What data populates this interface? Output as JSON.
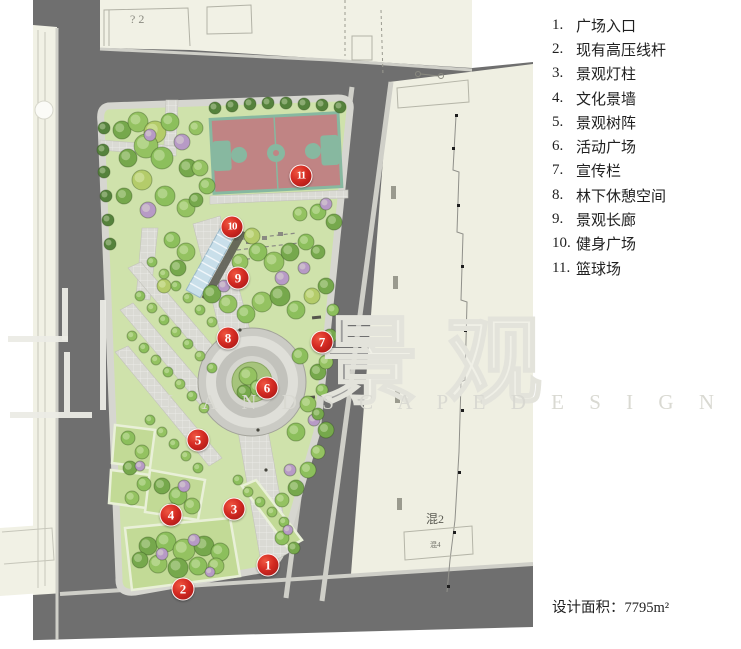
{
  "page": {
    "type": "landscape-site-plan"
  },
  "legend": {
    "items": [
      {
        "num": "1.",
        "label": "广场入口"
      },
      {
        "num": "2.",
        "label": "现有高压线杆"
      },
      {
        "num": "3.",
        "label": "景观灯柱"
      },
      {
        "num": "4.",
        "label": "文化景墙"
      },
      {
        "num": "5.",
        "label": "景观树阵"
      },
      {
        "num": "6.",
        "label": "活动广场"
      },
      {
        "num": "7.",
        "label": "宣传栏"
      },
      {
        "num": "8.",
        "label": "林下休憩空间"
      },
      {
        "num": "9.",
        "label": "景观长廊"
      },
      {
        "num": "10.",
        "label": "健身广场"
      },
      {
        "num": "11.",
        "label": "篮球场"
      }
    ]
  },
  "area_note": {
    "label": "设计面积：",
    "value": "7795m²"
  },
  "watermark": {
    "cn": "景观",
    "en": "L A N D S C A P E   D E S I G N"
  },
  "plan": {
    "markers": [
      {
        "n": "1",
        "x": 268,
        "y": 565
      },
      {
        "n": "2",
        "x": 183,
        "y": 589
      },
      {
        "n": "3",
        "x": 234,
        "y": 509
      },
      {
        "n": "4",
        "x": 171,
        "y": 515
      },
      {
        "n": "5",
        "x": 198,
        "y": 440
      },
      {
        "n": "6",
        "x": 267,
        "y": 388
      },
      {
        "n": "7",
        "x": 322,
        "y": 342
      },
      {
        "n": "8",
        "x": 228,
        "y": 338
      },
      {
        "n": "9",
        "x": 238,
        "y": 278
      },
      {
        "n": "10",
        "x": 232,
        "y": 227
      },
      {
        "n": "11",
        "x": 301,
        "y": 176
      }
    ],
    "building_labels": {
      "top": "? 2",
      "right": "混2",
      "right_small": "混4"
    }
  },
  "colors": {
    "road": "#6f6f6f",
    "site_green": "#cfe2ab",
    "court_red": "#c08484",
    "court_teal": "#87b8a0",
    "marker_red": "#c61f1f",
    "building_cream": "#f1f1e5"
  }
}
